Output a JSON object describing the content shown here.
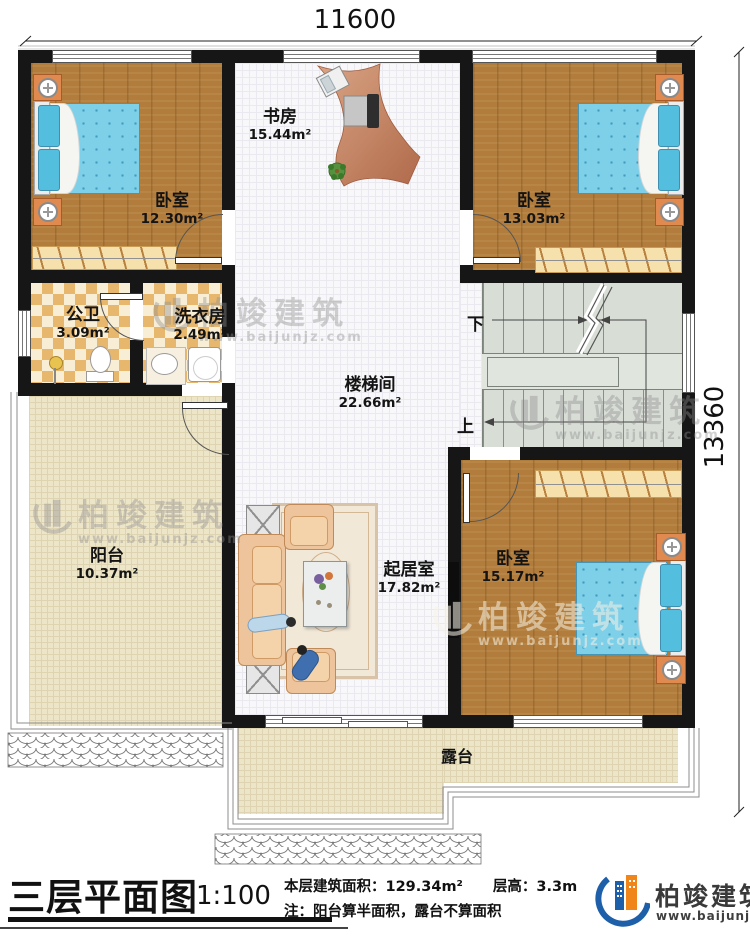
{
  "dimensions": {
    "width_label": "11600",
    "height_label": "13360"
  },
  "rooms": {
    "bedroom_tl": {
      "name": "卧室",
      "area": "12.30m²"
    },
    "study": {
      "name": "书房",
      "area": "15.44m²"
    },
    "bedroom_tr": {
      "name": "卧室",
      "area": "13.03m²"
    },
    "bathroom": {
      "name": "公卫",
      "area": "3.09m²"
    },
    "laundry": {
      "name": "洗衣房",
      "area": "2.49m²"
    },
    "stairwell": {
      "name": "楼梯间",
      "area": "22.66m²"
    },
    "balcony": {
      "name": "阳台",
      "area": "10.37m²"
    },
    "living": {
      "name": "起居室",
      "area": "17.82m²"
    },
    "bedroom_br": {
      "name": "卧室",
      "area": "15.17m²"
    },
    "terrace": {
      "name": "露台"
    }
  },
  "stairs": {
    "down_label": "下",
    "up_label": "上"
  },
  "footer": {
    "title": "三层平面图",
    "scale": "1:100",
    "area_text": "本层建筑面积：129.34m²",
    "floor_height_text": "层高：3.3m",
    "note_text": "注：阳台算半面积，露台不算面积",
    "brand": "柏竣建筑",
    "brand_url": "www.baijunjz.com"
  },
  "watermark": {
    "brand": "柏竣建筑",
    "url": "www.baijunjz.com"
  },
  "colors": {
    "brand_blue": "#1d5fa8",
    "brand_orange": "#f08519",
    "wall": "#161616",
    "wood_floor": "#b27d3c",
    "mattress_blue": "#7ecfe8",
    "checker_tan": "#e7b76e",
    "terrace_beige": "#ede5c8",
    "stair_gray": "#d8ded6"
  }
}
